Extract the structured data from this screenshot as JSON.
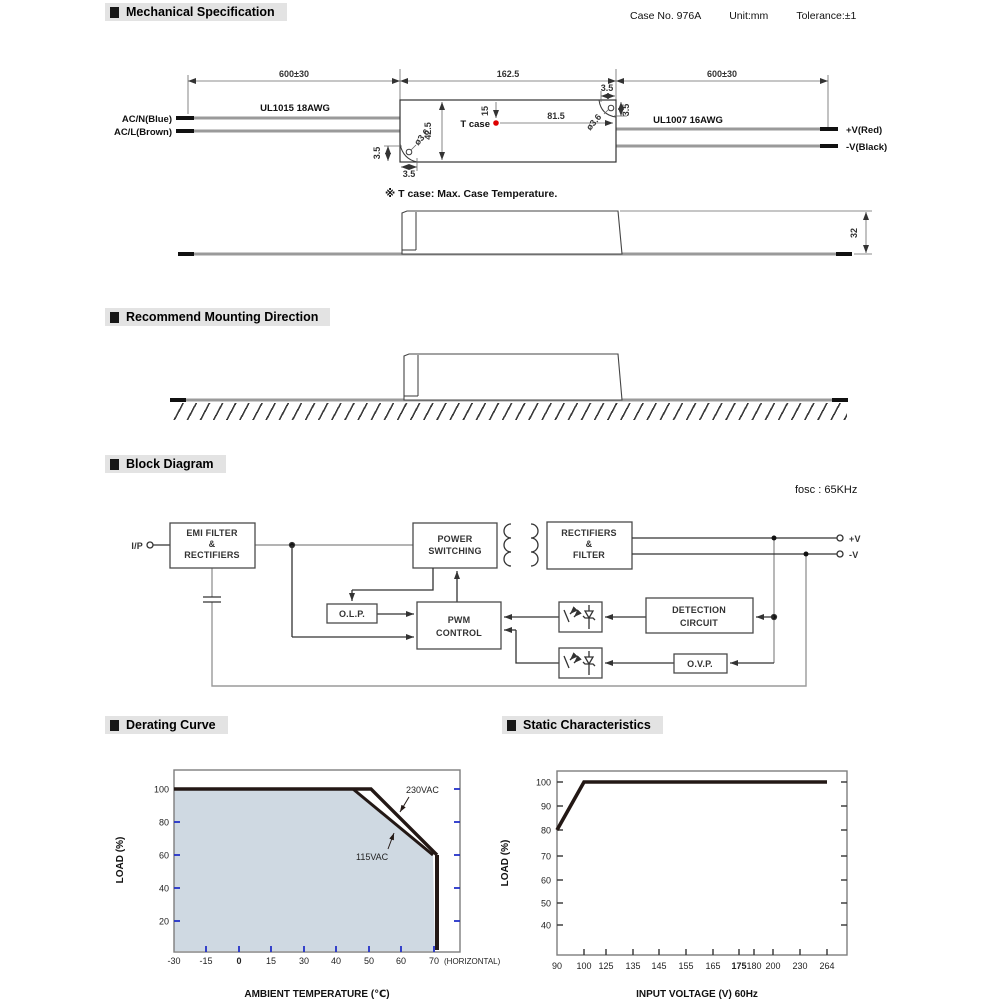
{
  "meta": {
    "case_no": "Case No. 976A",
    "unit": "Unit:mm",
    "tolerance": "Tolerance:±1"
  },
  "sections": {
    "mechanical": "Mechanical Specification",
    "mounting": "Recommend Mounting Direction",
    "block": "Block Diagram",
    "derating": "Derating Curve",
    "static_char": "Static Characteristics"
  },
  "mechanical": {
    "dim_wire_left": "600±30",
    "dim_case_length": "162.5",
    "dim_wire_right": "600±30",
    "wire_left_type": "UL1015 18AWG",
    "wire_right_type": "UL1007 16AWG",
    "ac_n": "AC/N(Blue)",
    "ac_l": "AC/L(Brown)",
    "v_plus": "+V(Red)",
    "v_minus": "-V(Black)",
    "t_case": "T case",
    "t_case_dot_color": "#dd0000",
    "dim_tcase_y": "15",
    "dim_tcase_x": "81.5",
    "dim_case_width": "42.5",
    "dim_hole_offset": "3.5",
    "hole_diameter": "ø3.6",
    "dim_case_height": "32",
    "note": "※ T case: Max. Case Temperature."
  },
  "block": {
    "fosc": "fosc : 65KHz",
    "ip": "I/P",
    "emi": [
      "EMI FILTER",
      "&",
      "RECTIFIERS"
    ],
    "power_switching": [
      "POWER",
      "SWITCHING"
    ],
    "rectifiers_filter": [
      "RECTIFIERS",
      "&",
      "FILTER"
    ],
    "pwm": [
      "PWM",
      "CONTROL"
    ],
    "olp": "O.L.P.",
    "detection": [
      "DETECTION",
      "CIRCUIT"
    ],
    "ovp": "O.V.P.",
    "v_plus": "+V",
    "v_minus": "-V"
  },
  "chart_data": [
    {
      "type": "area",
      "title": "Derating Curve",
      "xlabel": "AMBIENT TEMPERATURE (℃)",
      "ylabel": "LOAD (%)",
      "x_ticks": [
        "-30",
        "-15",
        "0",
        "15",
        "30",
        "40",
        "50",
        "60",
        "70"
      ],
      "x_note": "(HORIZONTAL)",
      "y_ticks": [
        20,
        40,
        60,
        80,
        100
      ],
      "ylim": [
        0,
        110
      ],
      "series": [
        {
          "name": "230VAC",
          "points": [
            [
              -30,
              100
            ],
            [
              50,
              100
            ],
            [
              70,
              60
            ],
            [
              70,
              0
            ]
          ]
        },
        {
          "name": "115VAC",
          "points": [
            [
              -30,
              100
            ],
            [
              45,
              100
            ],
            [
              70,
              60
            ],
            [
              70,
              0
            ]
          ]
        }
      ],
      "shaded_region": "area under 115VAC curve",
      "shade_color": "#cfd9e2",
      "tick_color": "#2431c8",
      "line_color": "#231815",
      "legend_position": "inline-annotations"
    },
    {
      "type": "line",
      "title": "Static Characteristics",
      "xlabel": "INPUT VOLTAGE (V) 60Hz",
      "ylabel": "LOAD (%)",
      "x_ticks": [
        "90",
        "100",
        "125",
        "135",
        "145",
        "155",
        "165",
        "175",
        "180",
        "200",
        "230",
        "264"
      ],
      "y_ticks": [
        40,
        50,
        60,
        70,
        80,
        90,
        100
      ],
      "ylim": [
        30,
        105
      ],
      "series": [
        {
          "name": "LOAD",
          "points": [
            [
              90,
              80
            ],
            [
              100,
              100
            ],
            [
              264,
              100
            ]
          ]
        }
      ],
      "line_color": "#231815"
    }
  ]
}
